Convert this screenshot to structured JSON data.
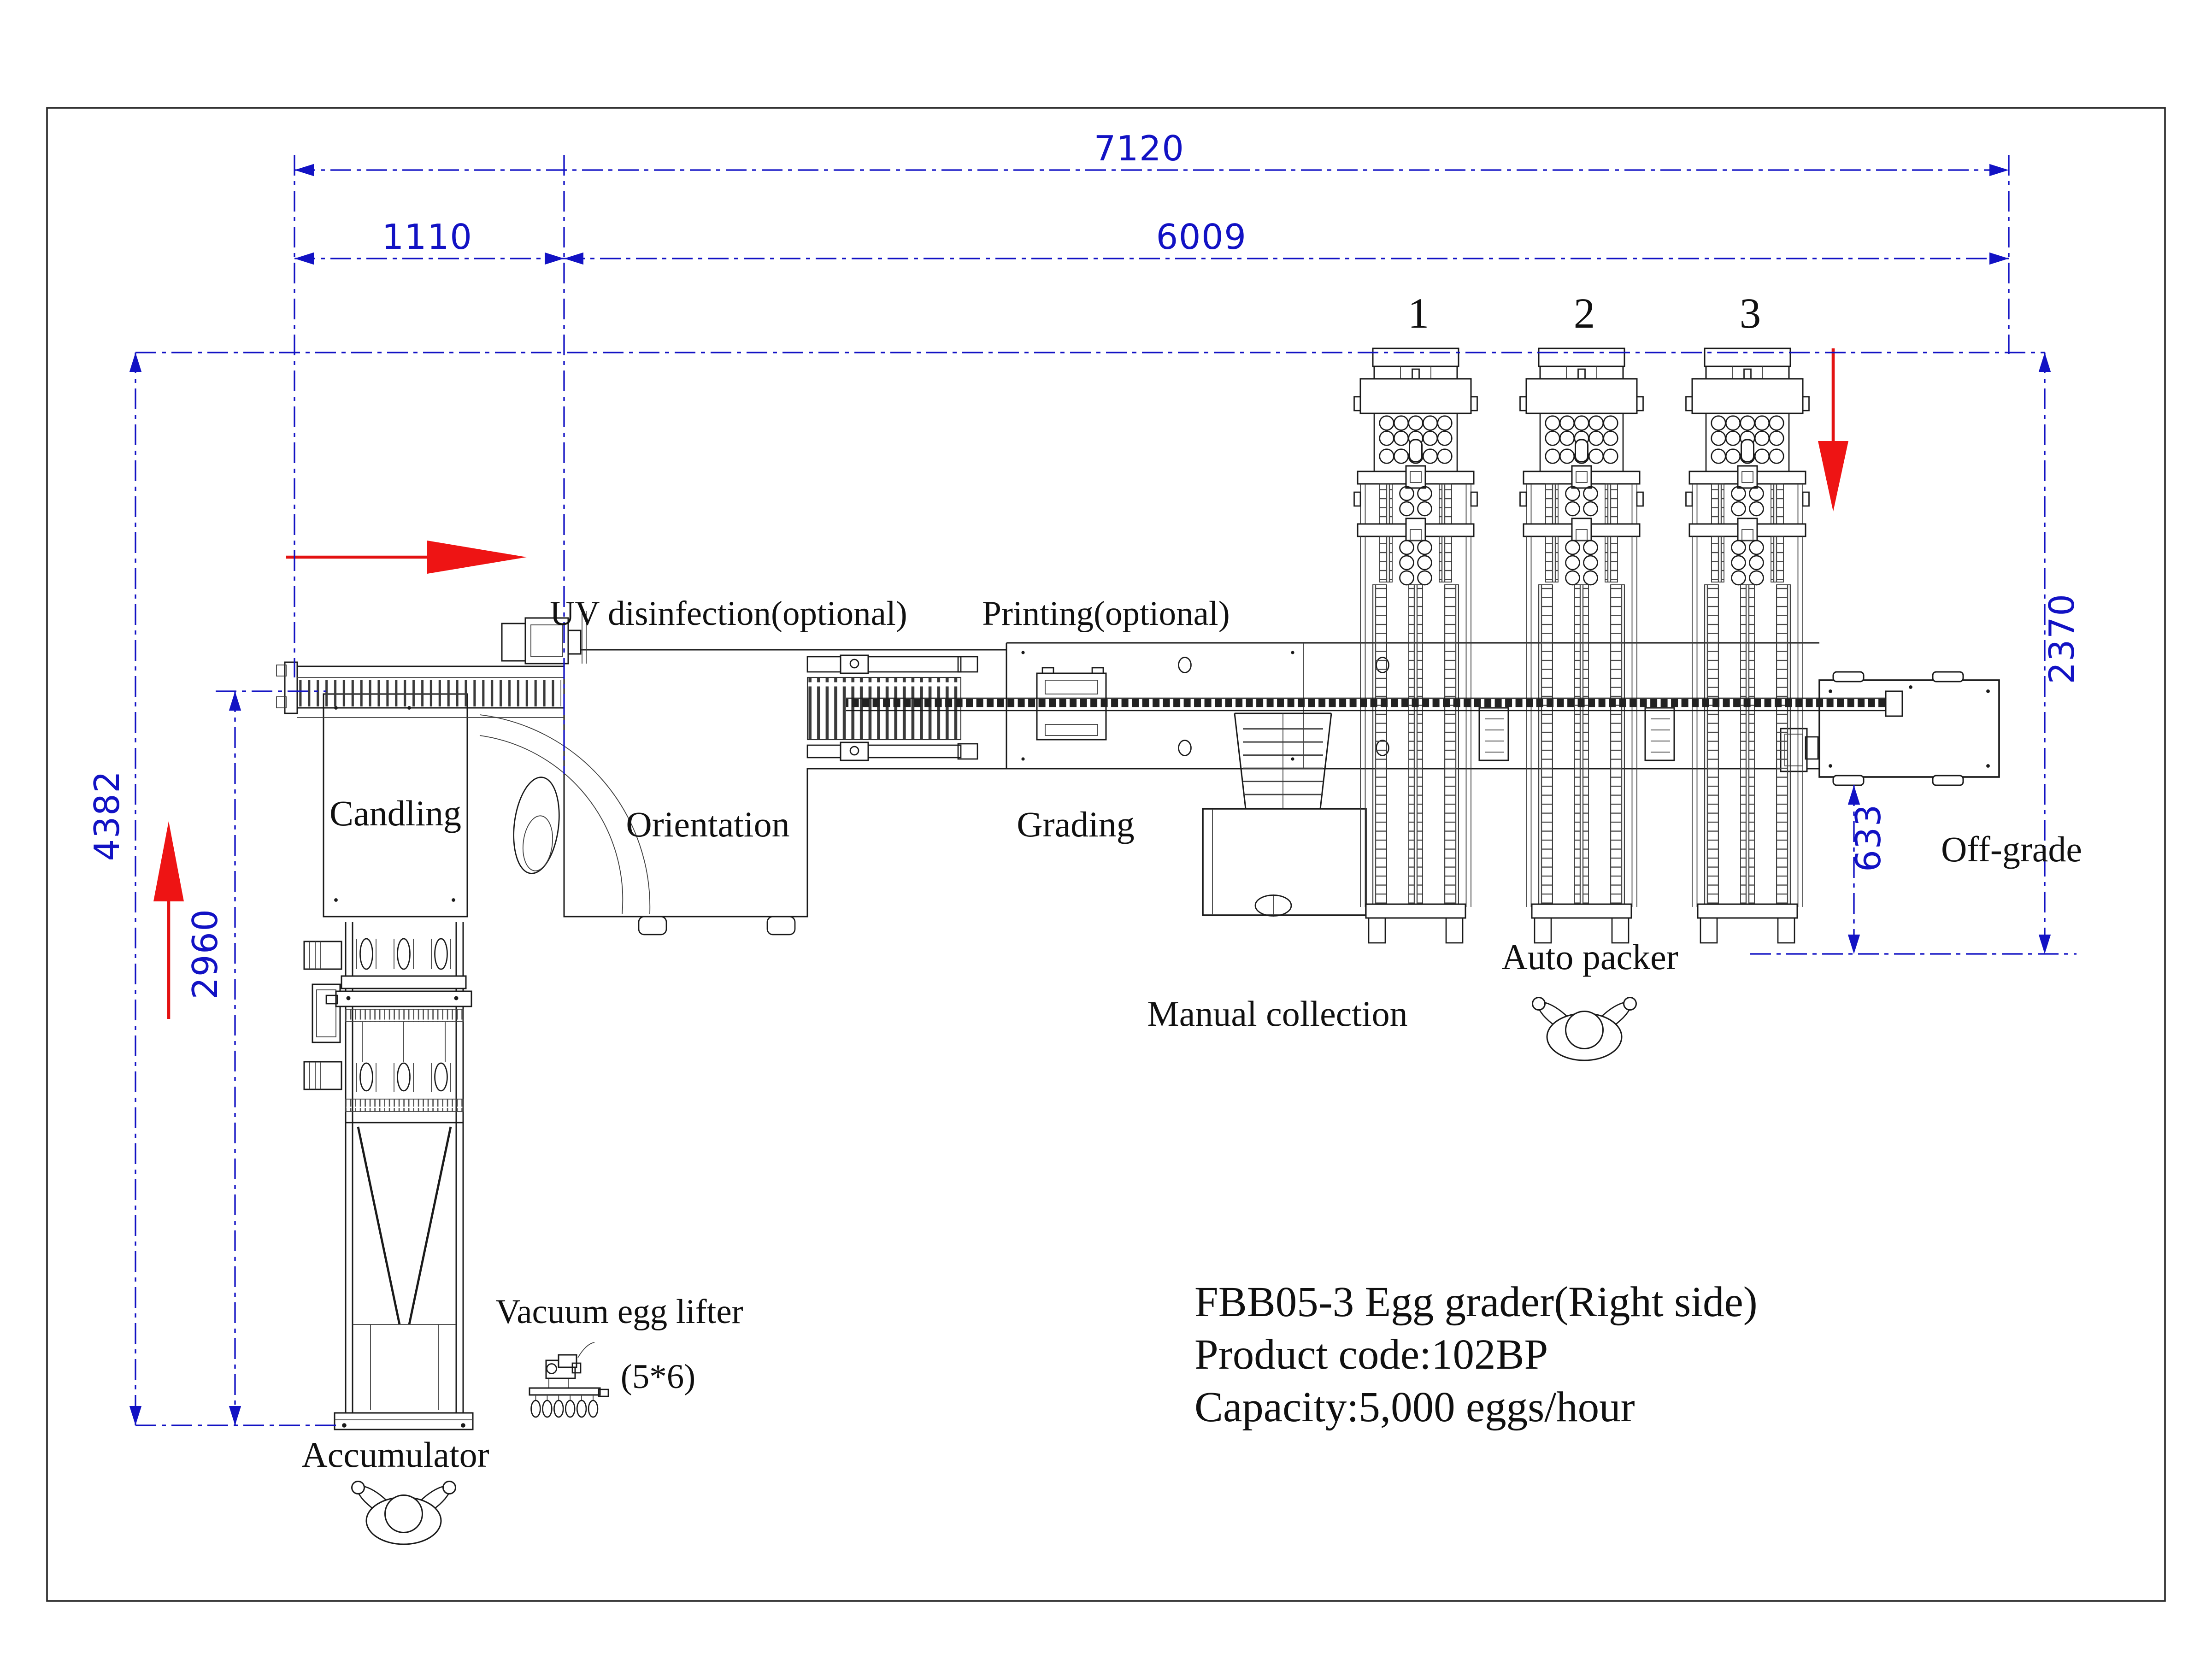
{
  "drawing": {
    "product": {
      "title": "FBB05-3 Egg grader(Right side)",
      "code_line": "Product code:102BP",
      "capacity_line": "Capacity:5,000 eggs/hour"
    },
    "dimensions_mm": {
      "total_length": "7120",
      "infeed_length": "1110",
      "grader_length": "6009",
      "total_depth": "4382",
      "accumulator_depth": "2960",
      "packer_depth": "2370",
      "offgrade_clearance": "633"
    },
    "station_labels": {
      "uv": "UV disinfection(optional)",
      "printing": "Printing(optional)",
      "candling": "Candling",
      "orientation": "Orientation",
      "grading": "Grading",
      "manual_collection": "Manual collection",
      "auto_packer": "Auto packer",
      "off_grade": "Off-grade",
      "vacuum_egg_lifter": "Vacuum egg lifter",
      "lifter_spec": "(5*6)",
      "accumulator": "Accumulator"
    },
    "packer_lane_numbers": [
      "1",
      "2",
      "3"
    ],
    "icons": {
      "flow_arrow": "red-flow-arrow",
      "operator": "operator-top-view-icon",
      "vacuum_lifter": "vacuum-egg-lifter-icon",
      "egg": "egg-outline-icon"
    },
    "colors": {
      "dimension_blue": "#1212c4",
      "flow_red": "#ee1414",
      "line_black": "#1a1a1a",
      "background": "#ffffff"
    }
  }
}
